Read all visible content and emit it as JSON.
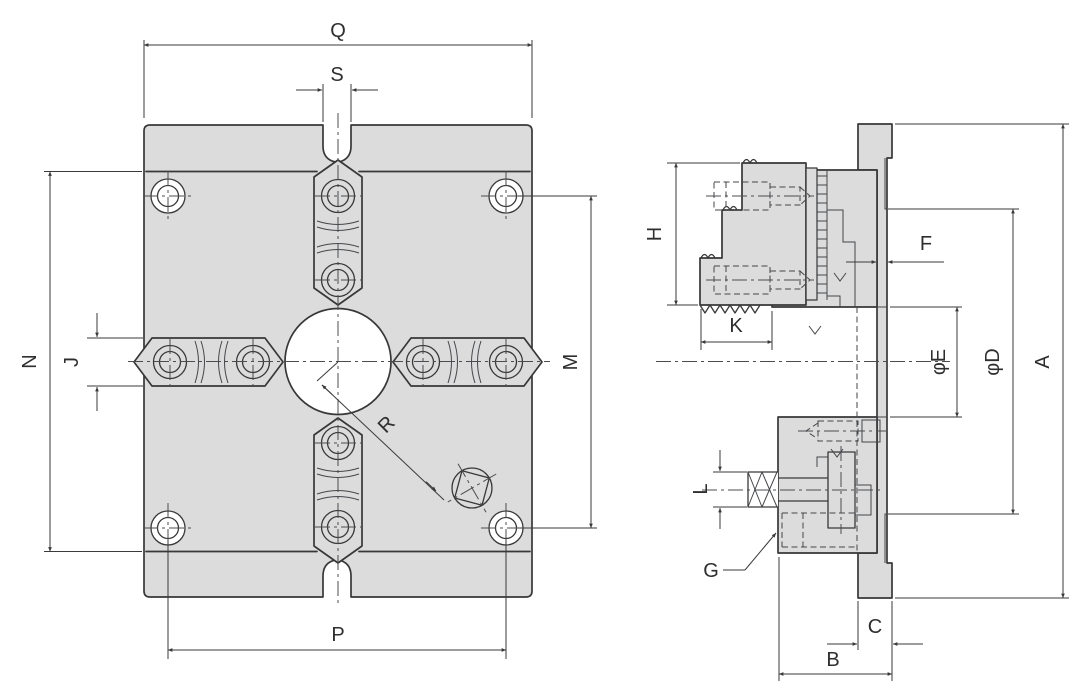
{
  "drawing": {
    "type": "technical-dimension-drawing",
    "front_view": {
      "labels": {
        "Q": "Q",
        "S": "S",
        "N": "N",
        "J": "J",
        "M": "M",
        "P": "P",
        "R": "R"
      }
    },
    "side_view": {
      "labels": {
        "H": "H",
        "K": "K",
        "F": "F",
        "E": "φE",
        "D": "φD",
        "A": "A",
        "L": "L",
        "G": "G",
        "C": "C",
        "B": "B"
      }
    }
  },
  "colors": {
    "body_fill": "#dcdcdc",
    "hole_fill": "#ffffff",
    "line": "#383838",
    "dim_line": "#3a3a3a",
    "background": "#ffffff"
  }
}
